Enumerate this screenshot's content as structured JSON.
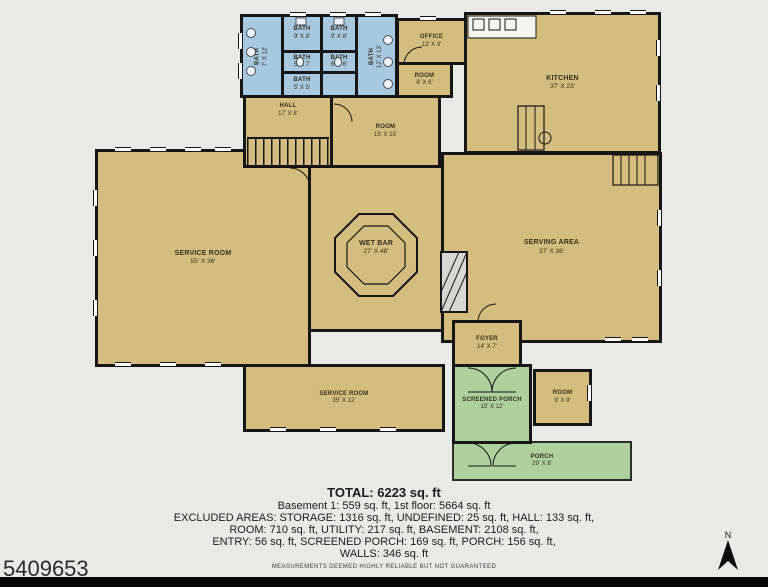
{
  "plan": {
    "rooms": [
      {
        "name": "BATH",
        "dims": "7' X 12'"
      },
      {
        "name": "BATH",
        "dims": "9' X 8'"
      },
      {
        "name": "BATH",
        "dims": "9' X 8'"
      },
      {
        "name": "BATH",
        "dims": "5' X 7'"
      },
      {
        "name": "BATH",
        "dims": "6' X 6'"
      },
      {
        "name": "BATH",
        "dims": "5' X 5'"
      },
      {
        "name": "BATH",
        "dims": "12' X 13'"
      },
      {
        "name": "OFFICE",
        "dims": "13' X 9'"
      },
      {
        "name": "ROOM",
        "dims": "8' X 6'"
      },
      {
        "name": "KITCHEN",
        "dims": "37' X 23'"
      },
      {
        "name": "HALL",
        "dims": "17' X 8'"
      },
      {
        "name": "ROOM",
        "dims": "15' X 15'"
      },
      {
        "name": "SERVICE ROOM",
        "dims": "55' X 36'"
      },
      {
        "name": "WET BAR",
        "dims": "27' X 48'"
      },
      {
        "name": "SERVING AREA",
        "dims": "37' X 36'"
      },
      {
        "name": "FOYER",
        "dims": "14' X 7'"
      },
      {
        "name": "SERVICE ROOM",
        "dims": "35' X 12'"
      },
      {
        "name": "SCREENED PORCH",
        "dims": "15' X 12'"
      },
      {
        "name": "ROOM",
        "dims": "9' X 9'"
      },
      {
        "name": "PORCH",
        "dims": "29' X 8'"
      }
    ]
  },
  "summary": {
    "total": "TOTAL: 6223 sq. ft",
    "lines": [
      "Basement 1: 559 sq. ft, 1st floor: 5664 sq. ft",
      "EXCLUDED AREAS: STORAGE: 1316 sq. ft, UNDEFINED: 25 sq. ft, HALL: 133 sq. ft,",
      "ROOM: 710 sq. ft, UTILITY: 217 sq. ft, BASEMENT: 2108 sq. ft,",
      "ENTRY: 56 sq. ft, SCREENED PORCH: 169 sq. ft, PORCH: 156 sq. ft,",
      "WALLS: 346 sq. ft"
    ]
  },
  "footer": {
    "photo_id": "5409653",
    "disclaimer": "MEASUREMENTS DEEMED HIGHLY RELIABLE BUT NOT GUARANTEED",
    "compass": "N"
  },
  "colors": {
    "room_fill": "#d5bd80",
    "bath_fill": "#a6c8e1",
    "porch_fill": "#aed19e",
    "wall": "#161616",
    "background": "#e9e9e7"
  }
}
